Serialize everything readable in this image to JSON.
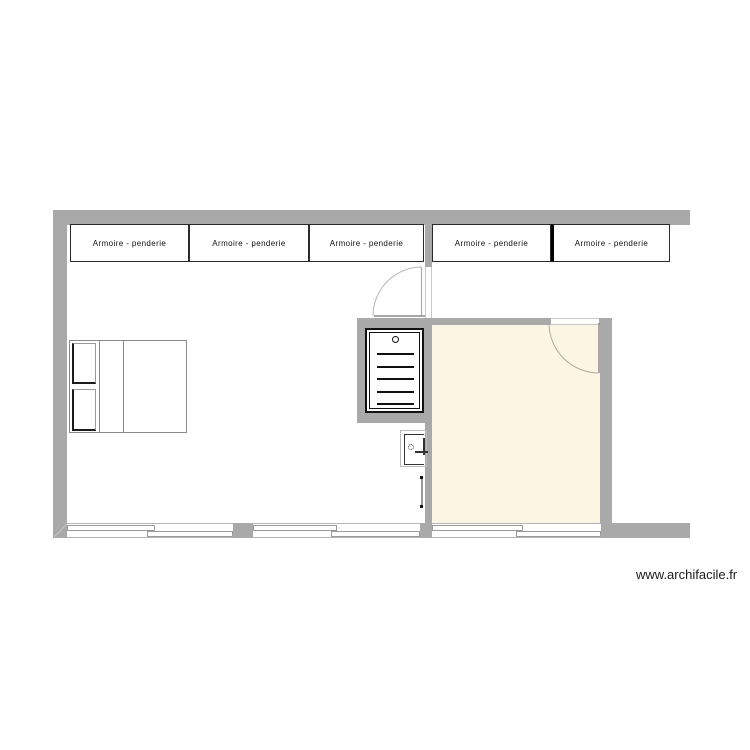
{
  "watermark": "www.archifacile.fr",
  "colors": {
    "wall": "#a9a9a9",
    "room_fill": "#fbf5e3",
    "outline": "#111111",
    "door_arc": "#b3b3b3",
    "background": "#ffffff"
  },
  "wardrobes": [
    {
      "label": "Armoire - penderie"
    },
    {
      "label": "Armoire - penderie"
    },
    {
      "label": "Armoire - penderie"
    },
    {
      "label": "Armoire - penderie"
    },
    {
      "label": "Armoire - penderie"
    }
  ],
  "symbols": {
    "bed": "double-bed-symbol",
    "radiator": "towel-radiator-symbol",
    "basin": "hand-basin-symbol",
    "door": "swing-door-symbol",
    "window": "sliding-window-symbol"
  }
}
